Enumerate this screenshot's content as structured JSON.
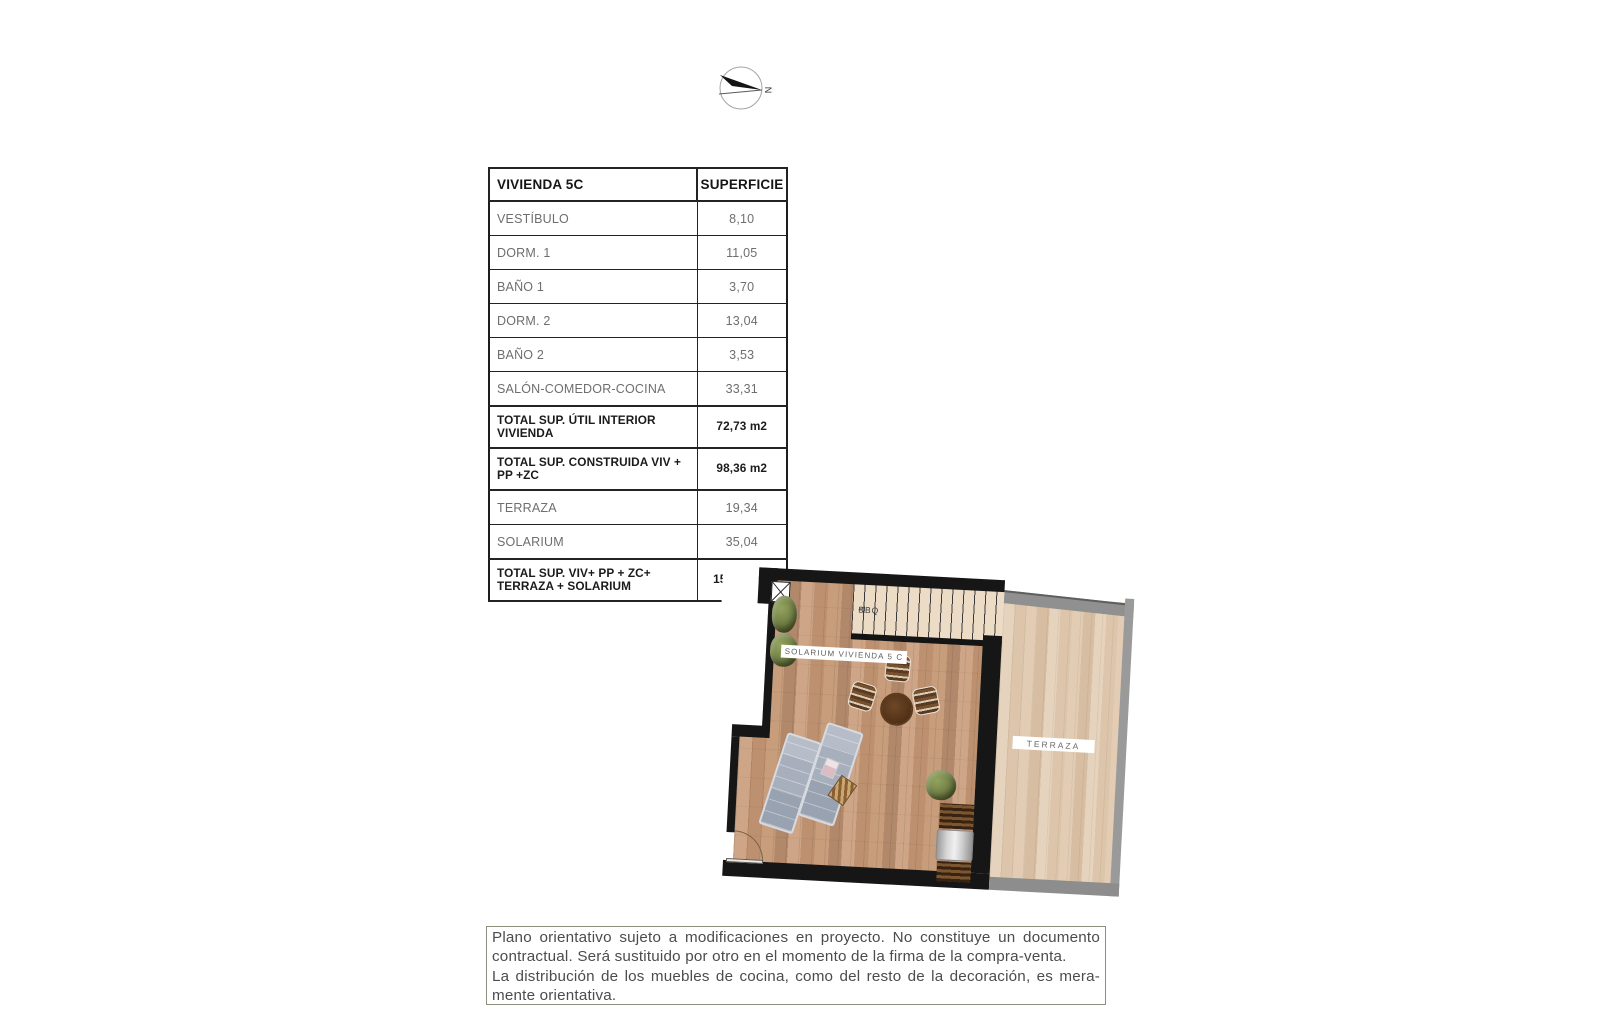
{
  "north_arrow": {
    "label": "N"
  },
  "table": {
    "header": [
      "VIVIENDA 5C",
      "SUPERFICIE"
    ],
    "rows": [
      {
        "label": "VESTÍBULO",
        "value": "8,10"
      },
      {
        "label": "DORM. 1",
        "value": "11,05"
      },
      {
        "label": "BAÑO 1",
        "value": "3,70"
      },
      {
        "label": "DORM. 2",
        "value": "13,04"
      },
      {
        "label": "BAÑO 2",
        "value": "3,53"
      },
      {
        "label": "SALÓN-COMEDOR-COCINA",
        "value": "33,31"
      },
      {
        "label": "TOTAL SUP. ÚTIL INTERIOR VIVIENDA",
        "value": "72,73 m2"
      },
      {
        "label": "TOTAL SUP. CONSTRUIDA VIV + PP +ZC",
        "value": "98,36 m2"
      },
      {
        "label": "TERRAZA",
        "value": "19,34"
      },
      {
        "label": "SOLARIUM",
        "value": "35,04"
      },
      {
        "label": "TOTAL SUP. VIV+ PP + ZC+ TERRAZA + SOLARIUM",
        "value": "152,07 m2"
      }
    ]
  },
  "plan": {
    "solarium_label": "SOLARIUM VIVIENDA 5 C",
    "terraza_label": "TERRAZA",
    "stairs_label": "BBQ",
    "stairs_arrow": "◁"
  },
  "disclaimer": {
    "line1": "Plano orientativo sujeto a modificaciones en proyecto. No constituye un documento",
    "line2": "contractual. Será sustituido por otro en el momento de la firma de la compra-venta.",
    "line3": "La distribución de los muebles de cocina, como del resto de la decoración, es mera-",
    "line4": "mente orientativa."
  },
  "colors": {
    "wall": "#161616",
    "solarium_wood": "#c29873",
    "terraza_wood": "#e0cab1",
    "terrace_band_gray": "#909090",
    "table_border": "#232323",
    "muted_text": "#6e6e70"
  }
}
